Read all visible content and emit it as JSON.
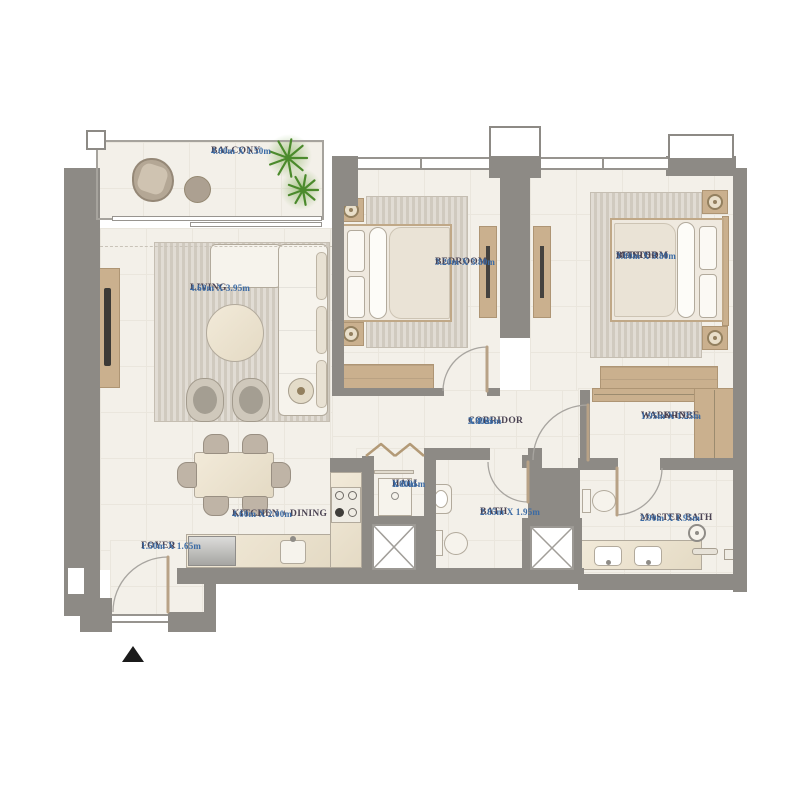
{
  "plan_type": "apartment-floor-plan",
  "rooms": {
    "balcony": {
      "name": "BALCONY",
      "dims": "4.00m X 1.50m"
    },
    "living": {
      "name": "LIVING",
      "dims": "4.60m X 3.95m"
    },
    "bedroom": {
      "name": "BEDROOM",
      "dims": "3.20m X 3.80m"
    },
    "master_bedroom": {
      "name1": "MASTER",
      "name2": "BEDROOM",
      "dims": "3.80m X 3.80m"
    },
    "corridor": {
      "name": "CORRIDOR",
      "dim1": "3.80m",
      "dim2": "X 1.25m"
    },
    "walk_in_wardrobe": {
      "name1": "WALK-IN",
      "name2": "WARDROBE",
      "dims": "1.95m X 1.25m"
    },
    "hall": {
      "name": "HALL",
      "dim1": "1.00m",
      "dim2": "X 0.95m"
    },
    "bath": {
      "name": "BATH",
      "dims": "2.85m X 1.95m"
    },
    "master_bath": {
      "name": "MASTER BATH",
      "dims": "2.90m X 1.95m"
    },
    "kitchen_dining": {
      "name": "KITCHEN + DINING",
      "dims": "4.60m X 2.00m"
    },
    "foyer": {
      "name": "FOYER",
      "dims": "1.50m X 1.65m"
    }
  },
  "icons": {
    "north_marker": "black-triangle-up",
    "plants": "balcony-plants",
    "shafts": "crossed-duct-box"
  },
  "colors": {
    "wall": "#8d8a85",
    "floor": "#f3f0e9",
    "wood": "#cab08e",
    "rug": "#d7d0c5",
    "room_name_text": "#4b4353",
    "dimension_text": "#3b6ba5",
    "plant_green": "#4b8a2c"
  }
}
